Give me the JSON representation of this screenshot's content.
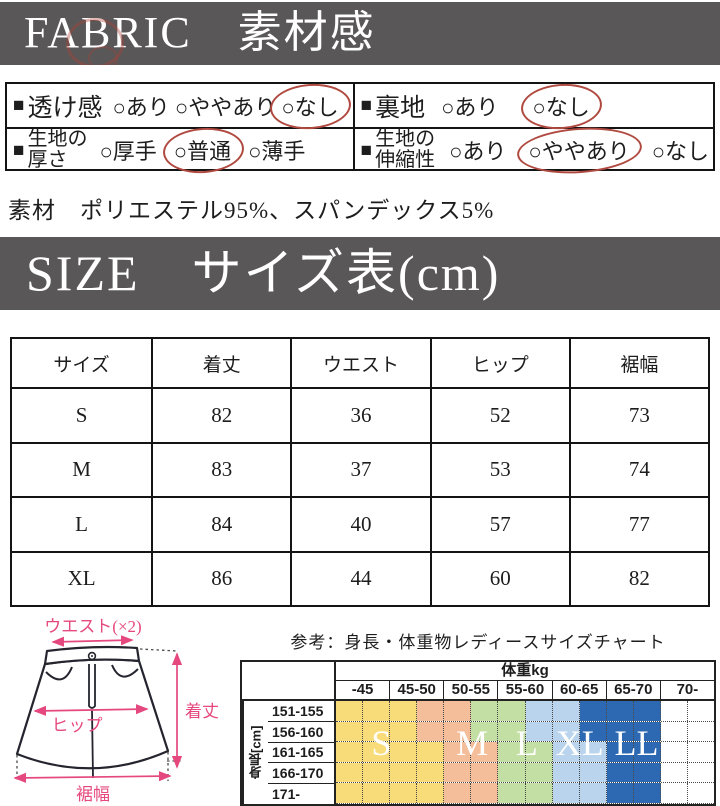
{
  "fabric": {
    "banner": "FABRIC　素材感",
    "bullet": "■",
    "rows": [
      {
        "label_lines": [
          "透け感"
        ],
        "options": [
          {
            "t": "○あり",
            "c": false
          },
          {
            "t": "○ややあり",
            "c": false
          },
          {
            "t": "○なし",
            "c": true
          }
        ]
      },
      {
        "label_lines": [
          "裏地"
        ],
        "options": [
          {
            "t": "○あり",
            "c": false
          },
          {
            "t": "○なし",
            "c": true
          }
        ]
      },
      {
        "label_lines": [
          "生地の",
          "厚さ"
        ],
        "options": [
          {
            "t": "○厚手",
            "c": false
          },
          {
            "t": "○普通",
            "c": true
          },
          {
            "t": "○薄手",
            "c": false
          }
        ]
      },
      {
        "label_lines": [
          "生地の",
          "伸縮性"
        ],
        "options": [
          {
            "t": "○あり",
            "c": false
          },
          {
            "t": "○ややあり",
            "c": true
          },
          {
            "t": "○なし",
            "c": false
          }
        ]
      }
    ],
    "material": "素材　ポリエステル95%、スパンデックス5%",
    "circle_color": "#b04a40"
  },
  "size_section": {
    "banner": "SIZE　サイズ表(cm)",
    "headers": [
      "サイズ",
      "着丈",
      "ウエスト",
      "ヒップ",
      "裾幅"
    ],
    "rows": [
      [
        "S",
        "82",
        "36",
        "52",
        "73"
      ],
      [
        "M",
        "83",
        "37",
        "53",
        "74"
      ],
      [
        "L",
        "84",
        "40",
        "57",
        "77"
      ],
      [
        "XL",
        "86",
        "44",
        "60",
        "82"
      ]
    ]
  },
  "diagram": {
    "waist_label": "ウエスト(×2)",
    "hip_label": "ヒップ",
    "length_label": "着丈",
    "hem_label": "裾幅",
    "accent_color": "#e5487e",
    "outline_color": "#25252f"
  },
  "reference_chart": {
    "title": "参考：身長・体重物レディースサイズチャート",
    "weight_header": "体重kg",
    "weight_cols": [
      "-45",
      "45-50",
      "50-55",
      "55-60",
      "60-65",
      "65-70",
      "70-"
    ],
    "height_header": "身長[cm]",
    "size_labels": [
      "S",
      "M",
      "L",
      "XL",
      "LL"
    ],
    "size_colors": {
      "S": "#F8DC7A",
      "M": "#F4BE9B",
      "L": "#C3DFA4",
      "XL": "#B9D4EC",
      "LL": "#2D68B2"
    },
    "rows": [
      {
        "label": "151-155",
        "cells": [
          "#F8DC7A",
          "#F8DC7A",
          "#F8DC7A",
          "#F4BE9B",
          "#F4BE9B",
          "#C3DFA4",
          "#C3DFA4",
          "#B9D4EC",
          "#B9D4EC",
          "#2D68B2",
          "#2D68B2",
          "#2D68B2",
          "#FFFFFF",
          "#FFFFFF"
        ]
      },
      {
        "label": "156-160",
        "cells": [
          "#F8DC7A",
          "#F8DC7A",
          "#F8DC7A",
          "#F4BE9B",
          "#F4BE9B",
          "#C3DFA4",
          "#C3DFA4",
          "#B9D4EC",
          "#B9D4EC",
          "#2D68B2",
          "#2D68B2",
          "#2D68B2",
          "#FFFFFF",
          "#FFFFFF"
        ]
      },
      {
        "label": "161-165",
        "cells": [
          "#F8DC7A",
          "#F8DC7A",
          "#F8DC7A",
          "#F8DC7A",
          "#F4BE9B",
          "#F4BE9B",
          "#C3DFA4",
          "#C3DFA4",
          "#B9D4EC",
          "#B9D4EC",
          "#2D68B2",
          "#2D68B2",
          "#FFFFFF",
          "#FFFFFF"
        ]
      },
      {
        "label": "166-170",
        "cells": [
          "#F8DC7A",
          "#F8DC7A",
          "#F8DC7A",
          "#F8DC7A",
          "#F4BE9B",
          "#F4BE9B",
          "#C3DFA4",
          "#C3DFA4",
          "#B9D4EC",
          "#B9D4EC",
          "#2D68B2",
          "#2D68B2",
          "#FFFFFF",
          "#FFFFFF"
        ]
      },
      {
        "label": "171-",
        "cells": [
          "#F8DC7A",
          "#F8DC7A",
          "#F8DC7A",
          "#F8DC7A",
          "#F4BE9B",
          "#F4BE9B",
          "#C3DFA4",
          "#C3DFA4",
          "#B9D4EC",
          "#B9D4EC",
          "#2D68B2",
          "#2D68B2",
          "#FFFFFF",
          "#FFFFFF"
        ]
      }
    ]
  }
}
